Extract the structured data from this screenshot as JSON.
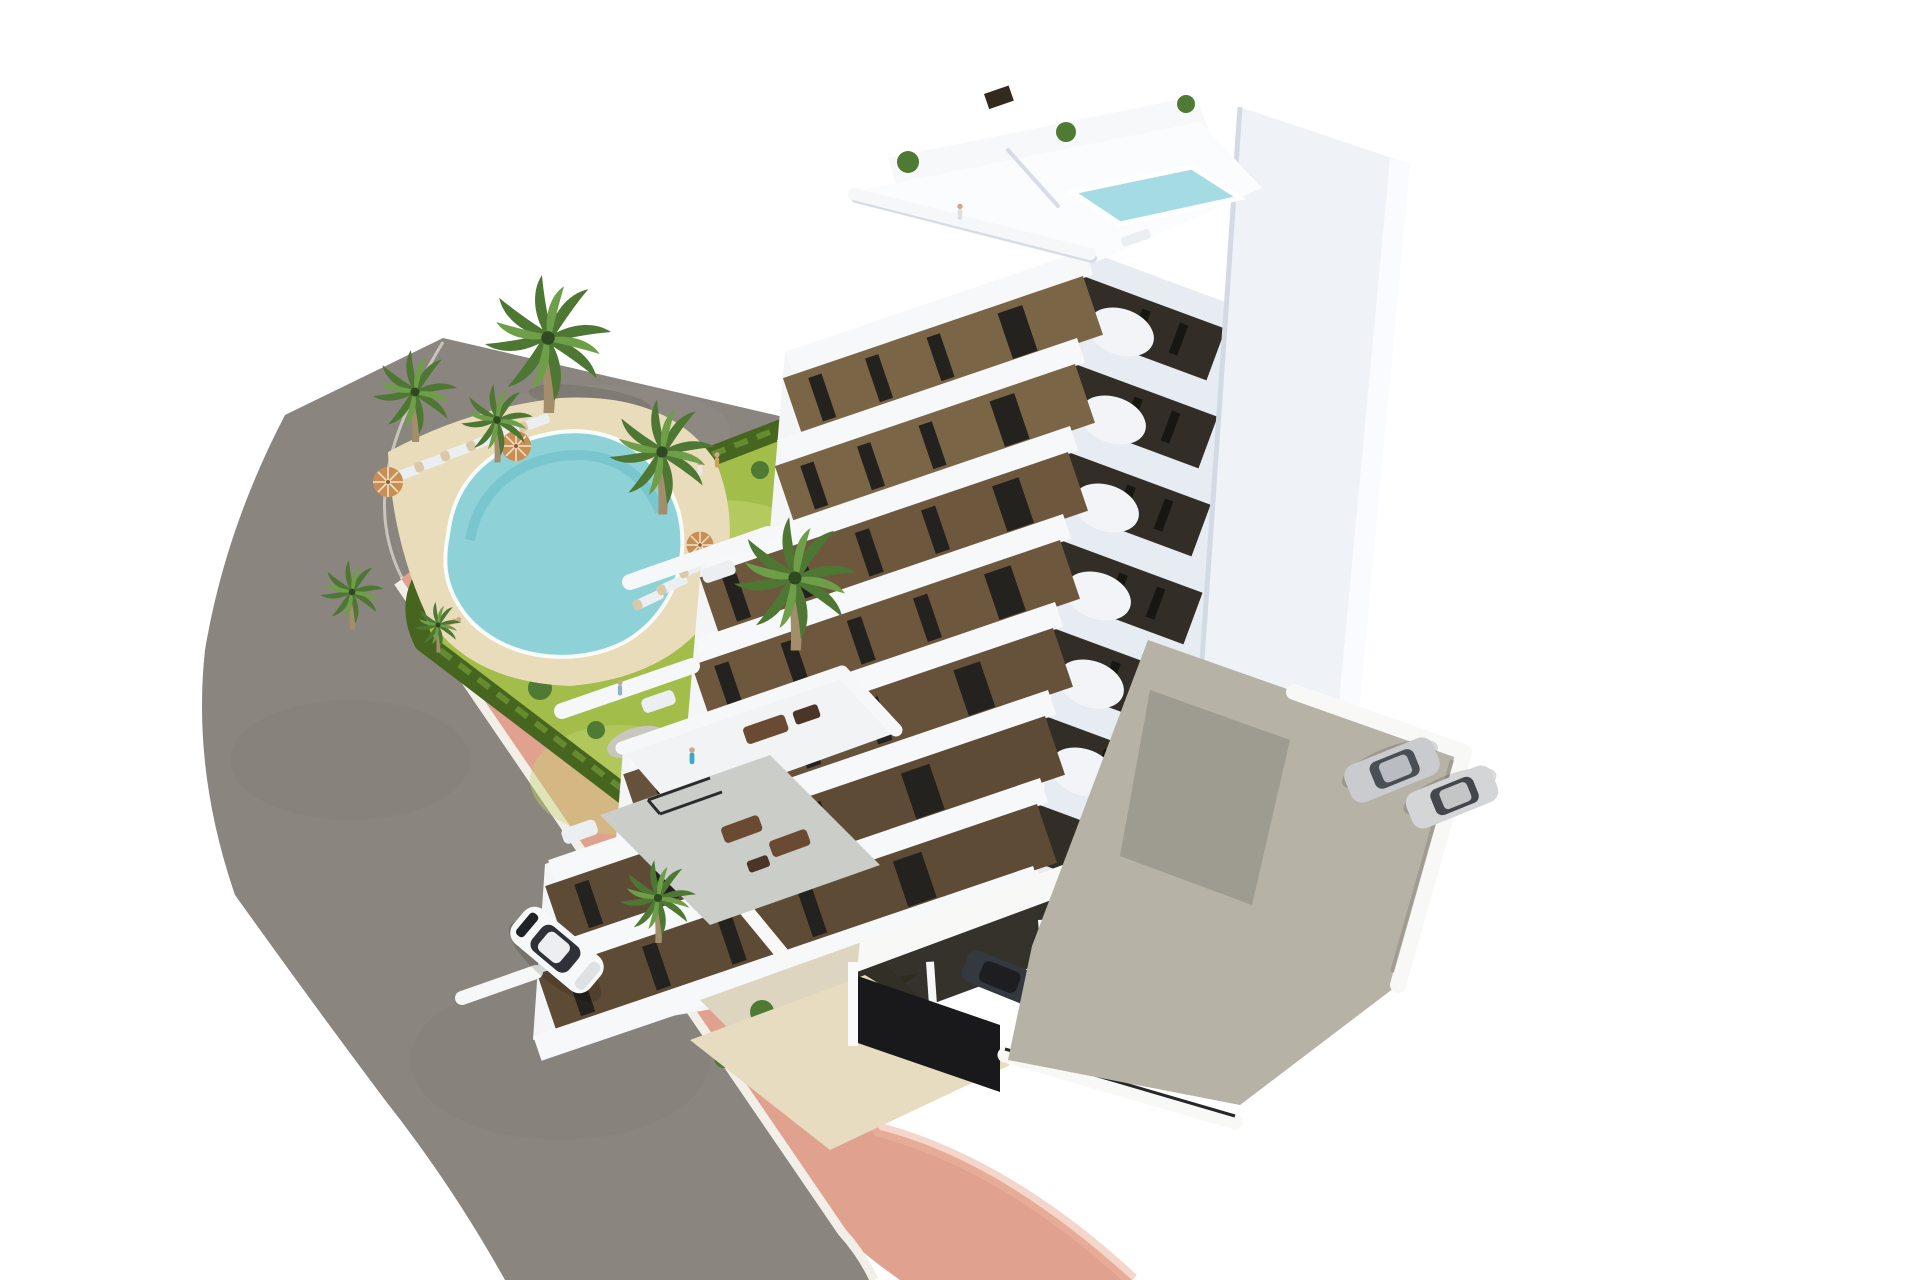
{
  "meta": {
    "kind": "architectural-3d-render",
    "description": "Aerial 3D render of a modern white-and-brown apartment tower with curved balconies, rooftop plunge pool, communal garden with kidney-shaped swimming pool, palm trees, curved asphalt road with salmon-pink sidewalk, white car driving, and a parking area with cars"
  },
  "palette": {
    "background": "#ffffff",
    "asphalt": "#8a857e",
    "asphaltEdge": "#d8d5cd",
    "curb": "#f2efe8",
    "sidewalkPink": "#e0a28e",
    "sidewalkPinkLight": "#ecb5a1",
    "hedge": "#46661f",
    "hedgeLight": "#6d9434",
    "lawn": "#a3bd4b",
    "lawnLight": "#c6d672",
    "sand": "#e9dcba",
    "gravel": "#c9c6bd",
    "poolWater": "#8ed2d8",
    "poolDeep": "#5fb8c4",
    "poolRim": "#ffffff",
    "swFacadeBase": "#f4f5f7",
    "seFacadeBase": "#e7ebf2",
    "fin": "#eff2f7",
    "finBright": "#fbfcfe",
    "roofDeck": "#fbfcfd",
    "roofParapet": "#f6f8fa",
    "roofPool": "#a5dbe2",
    "brownPanel": "#7b6547",
    "windowDark": "#24221e",
    "terracePave": "#cbcdc9",
    "patioBeige": "#ddd5c0",
    "apronBeige": "#e7dbc0",
    "wallWhite": "#f8f8f6",
    "concrete": "#b7b2a6",
    "concreteShadow": "#8f8b82",
    "garageDark": "#232119",
    "gateDark": "#19191b",
    "carWhite": "#f7f8f9",
    "carSilver": "#c9cbce",
    "carDark": "#34383f",
    "carNavy": "#23262e",
    "personBlue": "#3fa8c9",
    "umbrella": "#c98e52"
  },
  "scene": {
    "building": {
      "label": "apartment tower",
      "visible_floors": 7,
      "rooftop": {
        "pool": true,
        "terrace": true,
        "plants": 3
      },
      "facades": {
        "left": "white slabs with brown window panels and stepped terraces",
        "right": "shaded white with dark recessed balcony bands",
        "right_fin": "tall blank white wall"
      },
      "balcony_style": "rounded white curved parapets"
    },
    "garden": {
      "lawn": true,
      "swimming_pool": {
        "shape": "kidney",
        "water": "turquoise",
        "deck": "sand"
      },
      "sun_loungers": 9,
      "parasols": 3,
      "palm_trees": 8,
      "hedge_border": true
    },
    "streets": {
      "asphalt_road": "curved two-lane road wrapping the plot",
      "sidewalk": "salmon pink path with white curbs",
      "vacant_lot": "grey ground at top left"
    },
    "vehicles": {
      "driving_car": {
        "count": 1,
        "color": "white"
      },
      "parking_lot_cars": {
        "count": 2,
        "color": "silver"
      },
      "garage_cars": {
        "count": 4,
        "colors": [
          "dark",
          "white",
          "silver",
          "navy"
        ]
      }
    },
    "people_visible": 9
  }
}
